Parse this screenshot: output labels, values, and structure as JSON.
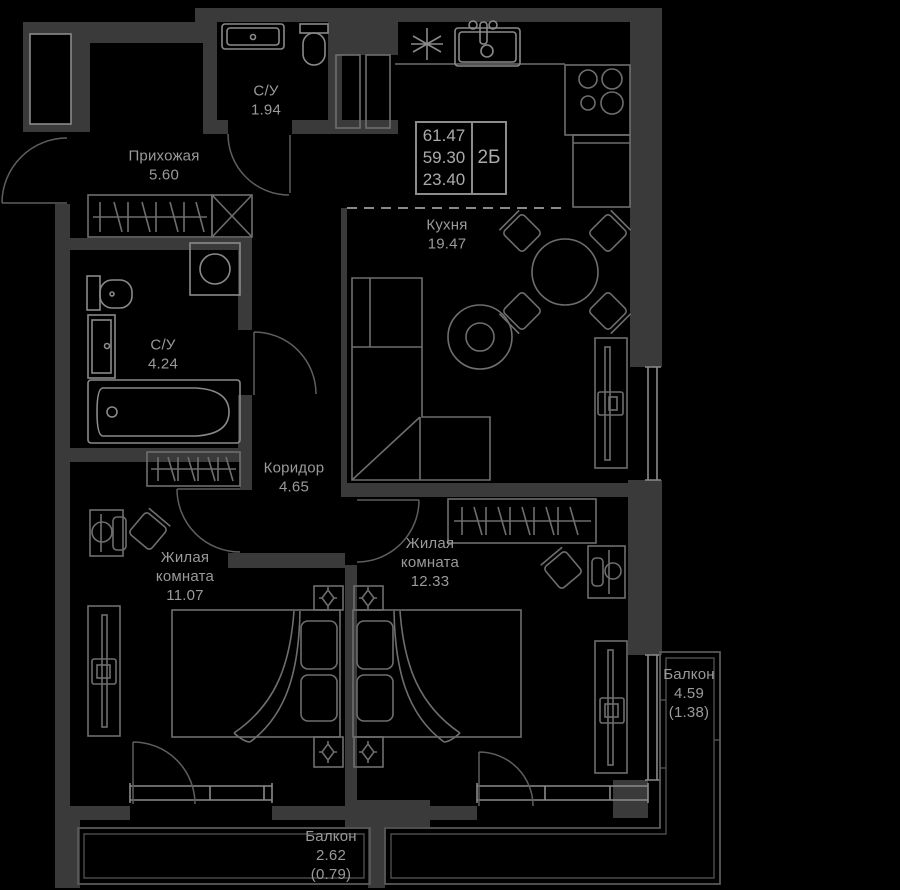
{
  "colors": {
    "background": "#000000",
    "wall": "#3a3a3a",
    "furniture": "#6e6e6e",
    "fixture": "#8a8a8a",
    "door": "#5e5e5e",
    "window": "#8a8a8a",
    "balcony": "#5a5a5a",
    "text": "#9a9a9a",
    "info_border": "#8c8c8c",
    "info_text": "#ababab"
  },
  "info_box": {
    "values": [
      "61.47",
      "59.30",
      "23.40"
    ],
    "type_label": "2Б"
  },
  "rooms": [
    {
      "id": "bathroom-top",
      "name": "С/У",
      "area": "1.94"
    },
    {
      "id": "hallway",
      "name": "Прихожая",
      "area": "5.60"
    },
    {
      "id": "kitchen",
      "name": "Кухня",
      "area": "19.47"
    },
    {
      "id": "bathroom-main",
      "name": "С/У",
      "area": "4.24"
    },
    {
      "id": "corridor",
      "name": "Коридор",
      "area": "4.65"
    },
    {
      "id": "bedroom-1",
      "name": "Жилая комната",
      "area": "11.07"
    },
    {
      "id": "bedroom-2",
      "name": "Жилая комната",
      "area": "12.33"
    },
    {
      "id": "balcony-right",
      "name": "Балкон",
      "area": "4.59",
      "reduced": "(1.38)"
    },
    {
      "id": "balcony-bottom",
      "name": "Балкон",
      "area": "2.62",
      "reduced": "(0.79)"
    }
  ]
}
